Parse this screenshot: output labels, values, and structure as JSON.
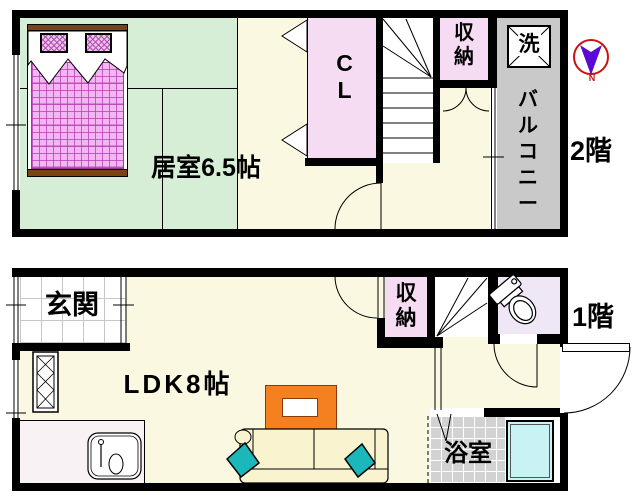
{
  "floor2": {
    "floor_label": "2階",
    "bedroom_label": "居室6.5帖",
    "closet_label": "CL",
    "storage_label": "収納",
    "washer_label": "洗",
    "balcony_label": "バルコニー",
    "compass_label": "N"
  },
  "floor1": {
    "floor_label": "1階",
    "entrance_label": "玄関",
    "ldk_label": "LDK8帖",
    "storage_label": "収納",
    "bathroom_label": "浴室"
  },
  "colors": {
    "wall": "#000000",
    "tatami_room_green": "#d6eed6",
    "hall_floor_cream": "#fbf8e2",
    "closet_pink": "#f6dcf2",
    "toilet_room_lavender": "#efe6f6",
    "balcony_gray": "#c9c9c9",
    "bath_tile_gray": "#d2d2d2",
    "bathtub_cyan": "#c8f2f4",
    "table_orange": "#f58020",
    "cushion_teal": "#1ab8ba",
    "sofa_cream": "#f9f3cf",
    "bed_purple": "#f4b6f2",
    "compass_red": "#cc1111",
    "compass_purple": "#5a0ad2"
  }
}
